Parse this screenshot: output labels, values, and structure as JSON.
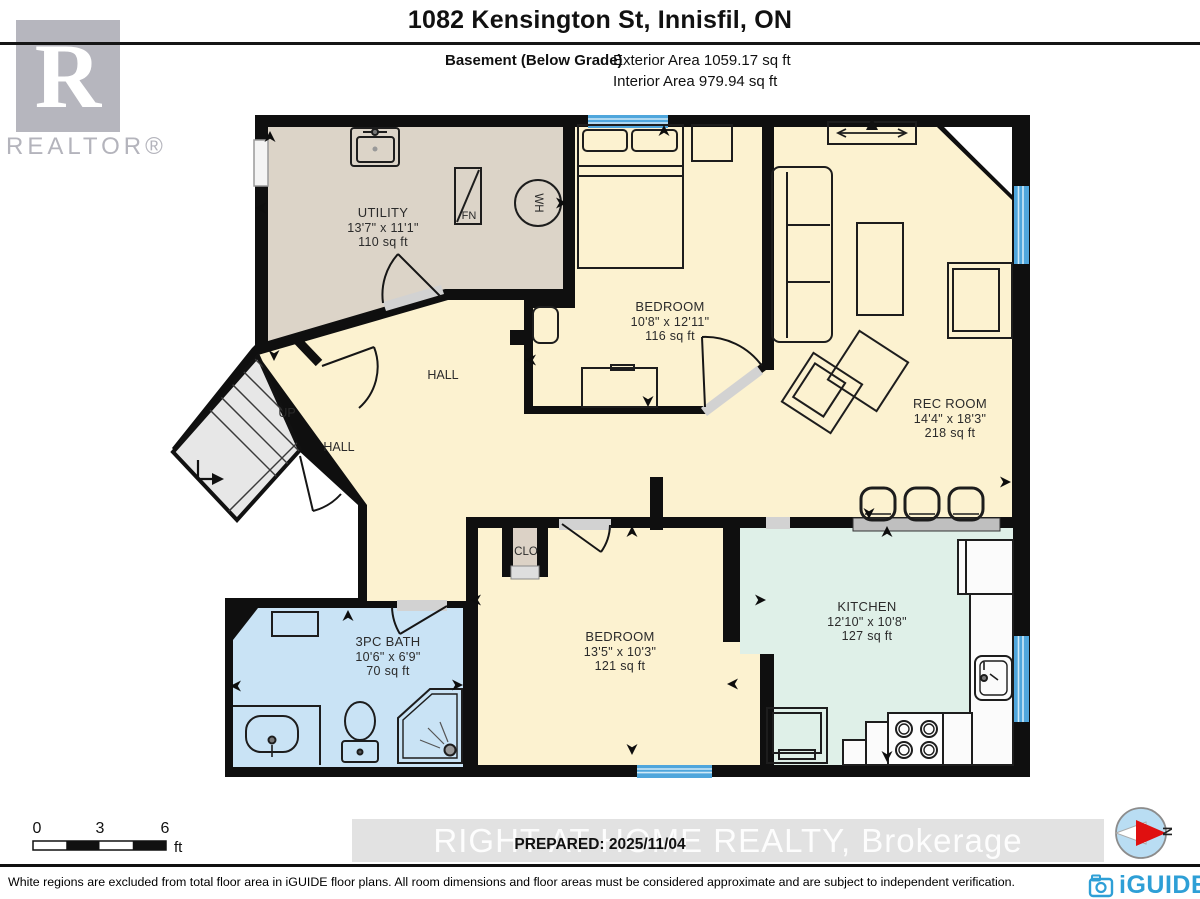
{
  "header": {
    "title": "1082 Kensington St, Innisfil, ON",
    "floor_label": "Basement (Below Grade)",
    "exterior_area": "Exterior Area 1059.17 sq ft",
    "interior_area": "Interior Area 979.94 sq ft"
  },
  "branding": {
    "realtor_letter": "R",
    "realtor_text": "REALTOR®",
    "iguide_text": "iGUIDE"
  },
  "rooms": {
    "utility": {
      "name": "UTILITY",
      "dims": "13'7\" x 11'1\"",
      "area": "110 sq ft"
    },
    "bedroom_top": {
      "name": "BEDROOM",
      "dims": "10'8\" x 12'11\"",
      "area": "116 sq ft"
    },
    "rec_room": {
      "name": "REC ROOM",
      "dims": "14'4\" x 18'3\"",
      "area": "218 sq ft"
    },
    "hall_main": {
      "name": "HALL"
    },
    "hall_small": {
      "name": "HALL"
    },
    "stairs": {
      "name": "UP"
    },
    "closet": {
      "name": "CLO"
    },
    "bath": {
      "name": "3PC BATH",
      "dims": "10'6\" x 6'9\"",
      "area": "70 sq ft"
    },
    "bedroom_bottom": {
      "name": "BEDROOM",
      "dims": "13'5\" x 10'3\"",
      "area": "121 sq ft"
    },
    "kitchen": {
      "name": "KITCHEN",
      "dims": "12'10\" x 10'8\"",
      "area": "127 sq ft"
    }
  },
  "fixtures": {
    "furnace": "FN",
    "water_heater": "WH"
  },
  "scale_bar": {
    "zero": "0",
    "three": "3",
    "six": "6",
    "unit": "ft"
  },
  "compass": {
    "north": "N"
  },
  "watermark": {
    "text": "RIGHT AT HOME REALTY, Brokerage"
  },
  "prepared": {
    "text": "PREPARED: 2025/11/04"
  },
  "footer": {
    "disclaimer": "White regions are excluded from total floor area in iGUIDE floor plans. All room dimensions and floor areas must be considered approximate and are subject to independent verification."
  },
  "colors": {
    "wall": "#0f0f0f",
    "cream_floor": "#FCF2D0",
    "utility_floor": "#DCD4C8",
    "bath_floor": "#C9E3F5",
    "kitchen_floor": "#DFF0E8",
    "window_blue": "#4FA6DC",
    "iguide_blue": "#2E9FD6",
    "compass_red": "#E01010",
    "realtor_gray": "#B6B6BE"
  }
}
